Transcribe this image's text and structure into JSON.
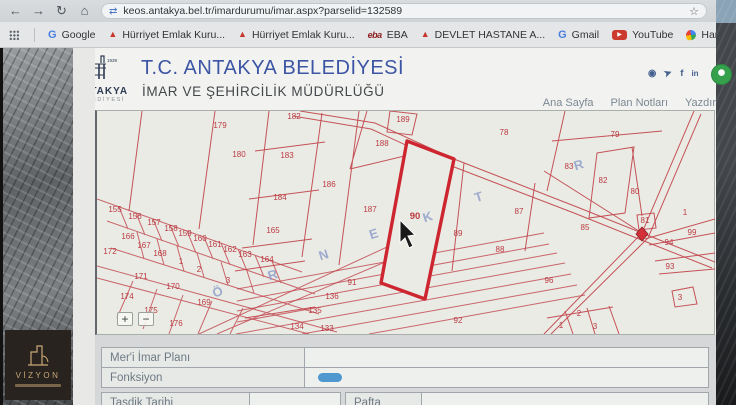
{
  "browser": {
    "url": "keos.antakya.bel.tr/imardurumu/imar.aspx?parselid=132589",
    "bookmarks": [
      {
        "label": "Google",
        "icon": "google-g"
      },
      {
        "label": "Hürriyet Emlak Kuru...",
        "icon": "red-caret"
      },
      {
        "label": "Hürriyet Emlak Kuru...",
        "icon": "red-caret"
      },
      {
        "label": "EBA",
        "icon": "eba-logo"
      },
      {
        "label": "DEVLET HASTANE A...",
        "icon": "red-caret"
      },
      {
        "label": "Gmail",
        "icon": "google-g"
      },
      {
        "label": "YouTube",
        "icon": "youtube"
      },
      {
        "label": "Haritalar",
        "icon": "maps-pin"
      },
      {
        "label": "Hızlı ve Öfkeli 6 izle...",
        "icon": "orange-badge"
      },
      {
        "label": "Translation Services...",
        "icon": "green-badge"
      }
    ]
  },
  "header": {
    "title": "T.C. ANTAKYA BELEDİYESİ",
    "subtitle": "İMAR VE ŞEHİRCİLİK MÜDÜRLÜĞÜ",
    "logo_name": "ANTAKYA",
    "logo_sub": "BELEDİYESİ",
    "logo_year": "1939",
    "nav": [
      "Ana Sayfa",
      "Plan Notları",
      "Yazdır"
    ]
  },
  "map": {
    "highlighted_parcel": "90",
    "zoom_in": "+",
    "zoom_out": "−",
    "parcel_labels": [
      {
        "n": "179",
        "x": 123,
        "y": 17
      },
      {
        "n": "180",
        "x": 142,
        "y": 46
      },
      {
        "n": "182",
        "x": 197,
        "y": 8
      },
      {
        "n": "183",
        "x": 190,
        "y": 47
      },
      {
        "n": "184",
        "x": 183,
        "y": 89
      },
      {
        "n": "186",
        "x": 232,
        "y": 76
      },
      {
        "n": "187",
        "x": 273,
        "y": 101
      },
      {
        "n": "188",
        "x": 285,
        "y": 35
      },
      {
        "n": "189",
        "x": 306,
        "y": 11
      },
      {
        "n": "90",
        "x": 318,
        "y": 108,
        "hl": true
      },
      {
        "n": "78",
        "x": 407,
        "y": 24
      },
      {
        "n": "79",
        "x": 518,
        "y": 26
      },
      {
        "n": "83",
        "x": 472,
        "y": 58
      },
      {
        "n": "82",
        "x": 506,
        "y": 72
      },
      {
        "n": "80",
        "x": 538,
        "y": 83
      },
      {
        "n": "81",
        "x": 548,
        "y": 112
      },
      {
        "n": "85",
        "x": 488,
        "y": 119
      },
      {
        "n": "87",
        "x": 422,
        "y": 103
      },
      {
        "n": "89",
        "x": 361,
        "y": 125
      },
      {
        "n": "88",
        "x": 403,
        "y": 141
      },
      {
        "n": "99",
        "x": 595,
        "y": 124
      },
      {
        "n": "94",
        "x": 572,
        "y": 134
      },
      {
        "n": "93",
        "x": 573,
        "y": 158
      },
      {
        "n": "96",
        "x": 452,
        "y": 172
      },
      {
        "n": "92",
        "x": 361,
        "y": 212
      },
      {
        "n": "91",
        "x": 255,
        "y": 174
      },
      {
        "n": "136",
        "x": 235,
        "y": 188
      },
      {
        "n": "135",
        "x": 218,
        "y": 202
      },
      {
        "n": "134",
        "x": 200,
        "y": 218
      },
      {
        "n": "133",
        "x": 230,
        "y": 220
      },
      {
        "n": "155",
        "x": 18,
        "y": 101
      },
      {
        "n": "156",
        "x": 38,
        "y": 108
      },
      {
        "n": "157",
        "x": 57,
        "y": 114
      },
      {
        "n": "158",
        "x": 74,
        "y": 120
      },
      {
        "n": "159",
        "x": 88,
        "y": 125
      },
      {
        "n": "160",
        "x": 103,
        "y": 130
      },
      {
        "n": "161",
        "x": 118,
        "y": 136
      },
      {
        "n": "162",
        "x": 133,
        "y": 141
      },
      {
        "n": "163",
        "x": 148,
        "y": 146
      },
      {
        "n": "164",
        "x": 170,
        "y": 151
      },
      {
        "n": "165",
        "x": 176,
        "y": 122
      },
      {
        "n": "166",
        "x": 31,
        "y": 128
      },
      {
        "n": "167",
        "x": 47,
        "y": 137
      },
      {
        "n": "168",
        "x": 63,
        "y": 145
      },
      {
        "n": "1",
        "x": 84,
        "y": 153
      },
      {
        "n": "2",
        "x": 102,
        "y": 161
      },
      {
        "n": "3",
        "x": 131,
        "y": 172
      },
      {
        "n": "172",
        "x": 13,
        "y": 143
      },
      {
        "n": "171",
        "x": 44,
        "y": 168
      },
      {
        "n": "170",
        "x": 76,
        "y": 178
      },
      {
        "n": "174",
        "x": 30,
        "y": 188
      },
      {
        "n": "175",
        "x": 54,
        "y": 202
      },
      {
        "n": "176",
        "x": 79,
        "y": 215
      },
      {
        "n": "169",
        "x": 107,
        "y": 194
      },
      {
        "n": "1",
        "x": 588,
        "y": 104
      },
      {
        "n": "3",
        "x": 583,
        "y": 189
      },
      {
        "n": "2",
        "x": 482,
        "y": 205
      },
      {
        "n": "1",
        "x": 464,
        "y": 217
      },
      {
        "n": "3",
        "x": 498,
        "y": 218
      }
    ],
    "street_letters": [
      {
        "ch": "Ö",
        "x": 122,
        "y": 185
      },
      {
        "ch": "R",
        "x": 177,
        "y": 168
      },
      {
        "ch": "N",
        "x": 228,
        "y": 148
      },
      {
        "ch": "E",
        "x": 278,
        "y": 127
      },
      {
        "ch": "K",
        "x": 332,
        "y": 110
      },
      {
        "ch": "T",
        "x": 383,
        "y": 90
      },
      {
        "ch": "R",
        "x": 483,
        "y": 58
      }
    ]
  },
  "panel": {
    "rows": [
      {
        "label": "Mer'i İmar Planı",
        "value": ""
      },
      {
        "label": "Fonksiyon",
        "value": ""
      }
    ],
    "rows2": [
      {
        "label": "Tasdik Tarihi",
        "value": ""
      },
      {
        "label": "Pafta",
        "value": ""
      }
    ]
  },
  "watermark": {
    "brand": "VİZYON"
  }
}
